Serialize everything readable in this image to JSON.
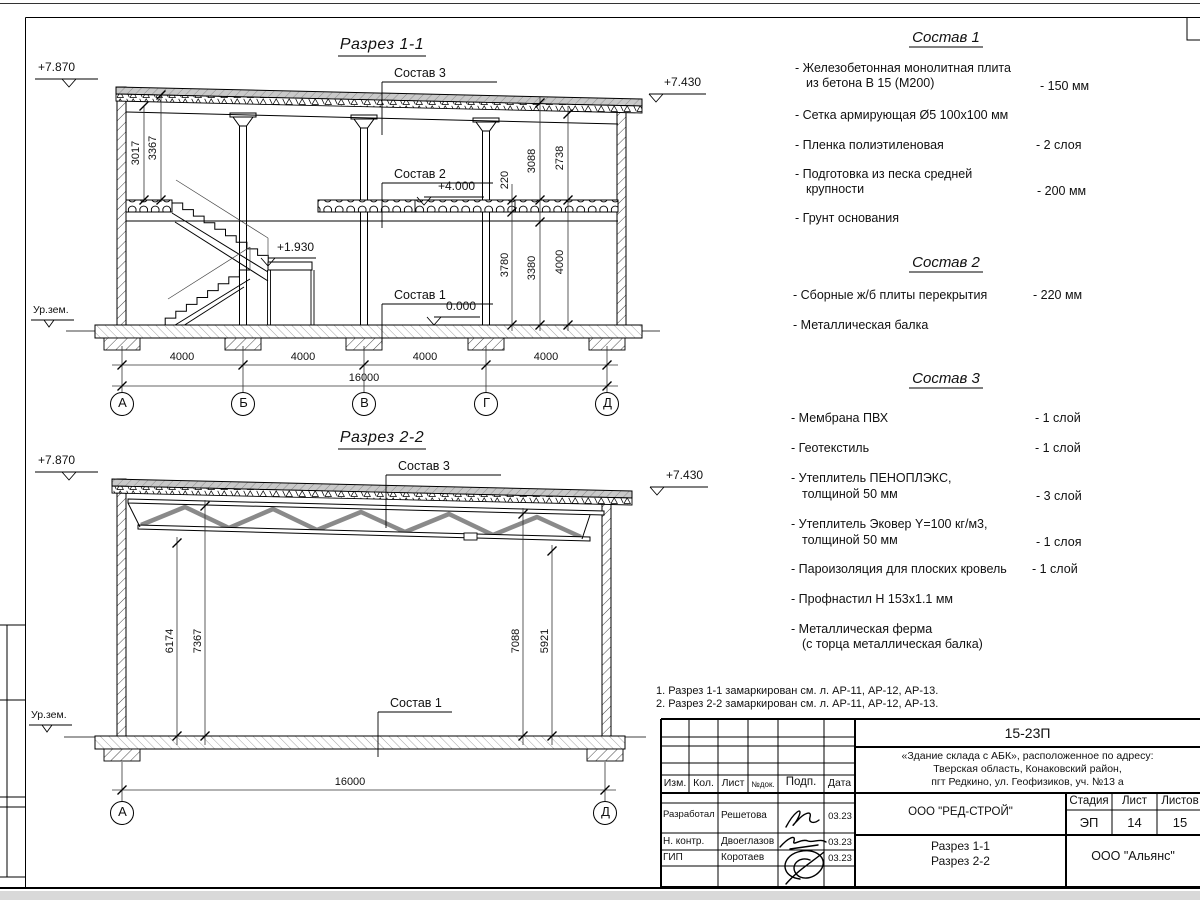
{
  "colors": {
    "line": "#000000",
    "insulation_fill": "#c9c9c9",
    "sheet_bg": "#ffffff"
  },
  "s11": {
    "title": "Разрез 1-1",
    "elev_tl": "+7.870",
    "elev_tr": "+7.430",
    "elev_mid": "+4.000",
    "elev_zero": "0.000",
    "elev_landing": "+1.930",
    "ground": "Ур.зем.",
    "lbl_sostav3": "Состав 3",
    "lbl_sostav2": "Состав 2",
    "lbl_sostav1": "Состав 1",
    "dim_3017": "3017",
    "dim_3367": "3367",
    "dim_220": "220",
    "dim_3088": "3088",
    "dim_2738": "2738",
    "dim_3780": "3780",
    "dim_3380": "3380",
    "dim_4000v": "4000",
    "bay1": "4000",
    "bay2": "4000",
    "bay3": "4000",
    "bay4": "4000",
    "total": "16000",
    "ax1": "А",
    "ax2": "Б",
    "ax3": "В",
    "ax4": "Г",
    "ax5": "Д"
  },
  "s22": {
    "title": "Разрез 2-2",
    "elev_tl": "+7.870",
    "elev_tr": "+7.430",
    "ground": "Ур.зем.",
    "lbl_sostav3": "Состав 3",
    "lbl_sostav1": "Состав 1",
    "dim_6174": "6174",
    "dim_7367": "7367",
    "dim_7088": "7088",
    "dim_5921": "5921",
    "total": "16000",
    "ax1": "А",
    "ax2": "Д"
  },
  "comp1": {
    "title": "Состав 1",
    "i1a": "- Железобетонная монолитная плита",
    "i1b": "из бетона В 15 (М200)",
    "i1v": "- 150 мм",
    "i2a": "- Сетка армирующая Ø5 100х100 мм",
    "i3a": "- Пленка полиэтиленовая",
    "i3v": "- 2 слоя",
    "i4a": "- Подготовка из песка средней",
    "i4b": "крупности",
    "i4v": "- 200 мм",
    "i5a": "- Грунт основания"
  },
  "comp2": {
    "title": "Состав 2",
    "i1a": "- Сборные ж/б плиты перекрытия",
    "i1v": "- 220 мм",
    "i2a": "- Металлическая балка"
  },
  "comp3": {
    "title": "Состав 3",
    "i1a": "- Мембрана ПВХ",
    "i1v": "- 1 слой",
    "i2a": "- Геотекстиль",
    "i2v": "- 1 слой",
    "i3a": "- Утеплитель ПЕНОПЛЭКС,",
    "i3b": "толщиной 50 мм",
    "i3v": "- 3 слой",
    "i4a": "- Утеплитель Эковер Y=100 кг/м3,",
    "i4b": "толщиной 50 мм",
    "i4v": "- 1 слоя",
    "i5a": "- Пароизоляция для плоских кровель",
    "i5v": "- 1 слой",
    "i6a": "- Профнастил Н 153х1.1 мм",
    "i7a": "- Металлическая ферма",
    "i7b": "(с торца металлическая балка)"
  },
  "notes": {
    "n1": "1. Разрез 1-1 замаркирован см. л. АР-11, АР-12, АР-13.",
    "n2": "2. Разрез 2-2 замаркирован см. л. АР-11, АР-12, АР-13."
  },
  "tb": {
    "doc": "15-23П",
    "proj1": "«Здание склада с АБК», расположенное по адресу:",
    "proj2": "Тверская область, Конаковский район,",
    "proj3": "пгт Редкино, ул. Геофизиков, уч. №13 а",
    "org": "ООО \"РЕД-СТРОЙ\"",
    "stage_h": "Стадия",
    "sheet_h": "Лист",
    "sheets_h": "Листов",
    "stage": "ЭП",
    "sheet": "14",
    "sheets": "15",
    "content1": "Разрез 1-1",
    "content2": "Разрез 2-2",
    "firm": "ООО \"Альянс\"",
    "h_izm": "Изм.",
    "h_kol": "Кол.",
    "h_list": "Лист",
    "h_ndok": "№док.",
    "h_podp": "Подп.",
    "h_data": "Дата",
    "r1c1": "Разработал",
    "r1c2": "Решетова",
    "r1d": "03.23",
    "r2c1": "Н. контр.",
    "r2c2": "Двоеглазов",
    "r2d": "03.23",
    "r3c1": "ГИП",
    "r3c2": "Коротаев",
    "r3d": "03.23"
  }
}
